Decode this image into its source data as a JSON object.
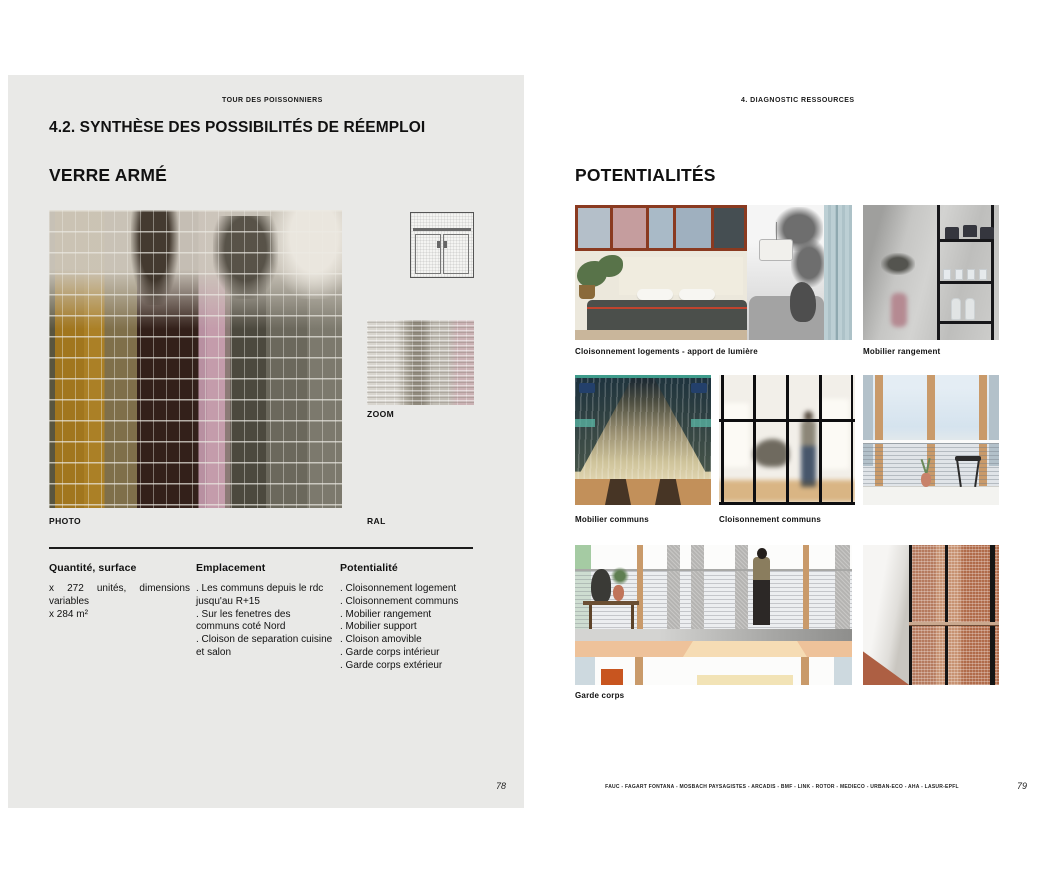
{
  "document": {
    "left_page": {
      "running_header": "TOUR DES POISSONNIERS",
      "section_title": "4.2. SYNTHÈSE DES POSSIBILITÉS DE RÉEMPLOI",
      "material_title": "VERRE ARMÉ",
      "photo_label": "PHOTO",
      "zoom_label": "ZOOM",
      "ral_label": "RAL",
      "columns": [
        {
          "heading": "Quantité, surface",
          "items": [
            "x 272 unités, dimensions variables",
            "x 284 m²"
          ]
        },
        {
          "heading": "Emplacement",
          "items": [
            ". Les communs depuis le rdc jusqu'au R+15",
            ". Sur les fenetres des communs coté Nord",
            ". Cloison de separation cuisine et salon"
          ]
        },
        {
          "heading": "Potentialité",
          "items": [
            ". Cloisonnement logement",
            ". Cloisonnement communs",
            ". Mobilier rangement",
            ". Mobilier support",
            ". Cloison amovible",
            ". Garde corps intérieur",
            ". Garde corps extérieur"
          ]
        }
      ],
      "page_number": "78"
    },
    "right_page": {
      "running_header": "4. DIAGNOSTIC RESSOURCES",
      "section_title": "POTENTIALITÉS",
      "captions": {
        "row1_left": "Cloisonnement logements - apport de lumière",
        "row1_right": "Mobilier rangement",
        "row2_left": "Mobilier communs",
        "row2_mid": "Cloisonnement communs",
        "row3": "Garde corps"
      },
      "page_number": "79"
    },
    "footer_credits": "FAUC - FAGART FONTANA - MOSBACH PAYSAGISTES - ARCADIS - BMF - LINK - ROTOR - MEDIECO - URBAN-ECO - AHA - LASUR-EPFL",
    "palette": {
      "page_left_bg": "#e9e9e7",
      "page_right_bg": "#ffffff",
      "text": "#111111",
      "amber_glass": "#a1761e",
      "maroon_glass": "#33201a",
      "pink_glass": "#c49cab",
      "copper_glass": "#c79272",
      "window_frame_red": "#8a3a20"
    }
  }
}
